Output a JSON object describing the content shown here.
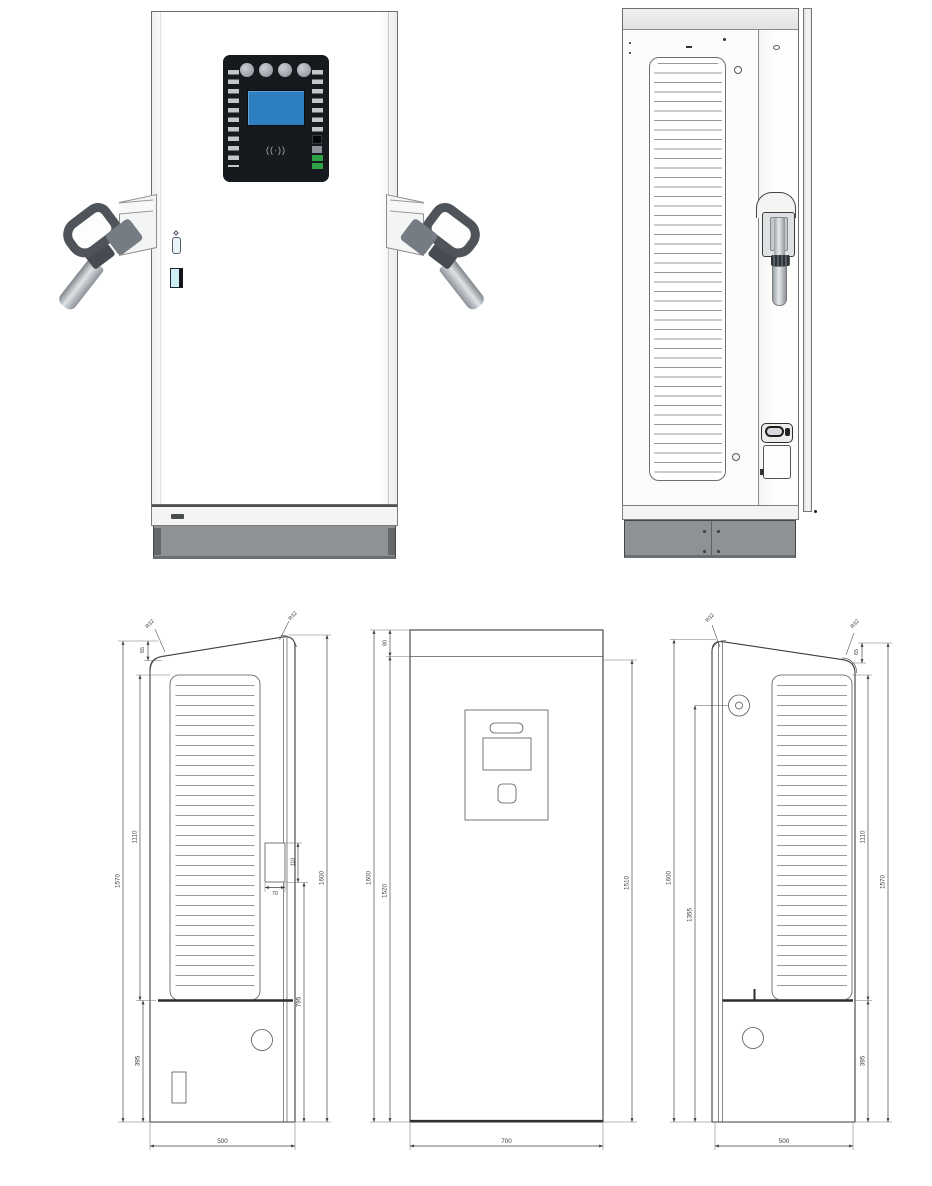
{
  "document": {
    "background": "#ffffff"
  },
  "renders": {
    "front": {
      "rfid_symbol": "((·))"
    },
    "side": {}
  },
  "colors": {
    "screen_blue": "#2d7fc2",
    "panel_black": "#16191d",
    "plinth_gray": "#8e9295",
    "led_green": "#2da245",
    "line": "#3d3d3d"
  },
  "drawings": {
    "left_side_view": {
      "dims": {
        "overall_height_left": "1570",
        "vent_height": "1110",
        "top_offset": "65",
        "corner_radius_left": "R32",
        "corner_radius_right": "R32",
        "handle_width": "70",
        "handle_height": "110",
        "handle_bottom": "795",
        "overall_height_right": "1600",
        "base_height": "395",
        "depth": "500"
      }
    },
    "front_view": {
      "dims": {
        "top_band": "80",
        "overall_height": "1600",
        "door_height": "1520",
        "right_height": "1510",
        "width": "700"
      }
    },
    "right_side_view": {
      "dims": {
        "overall_height_left": "1600",
        "gland_height": "1355",
        "vent_height": "1110",
        "overall_height_right": "1570",
        "top_offset": "65",
        "base_height": "395",
        "depth": "500",
        "corner_radius_left": "R32",
        "corner_radius_right": "R32"
      }
    }
  }
}
